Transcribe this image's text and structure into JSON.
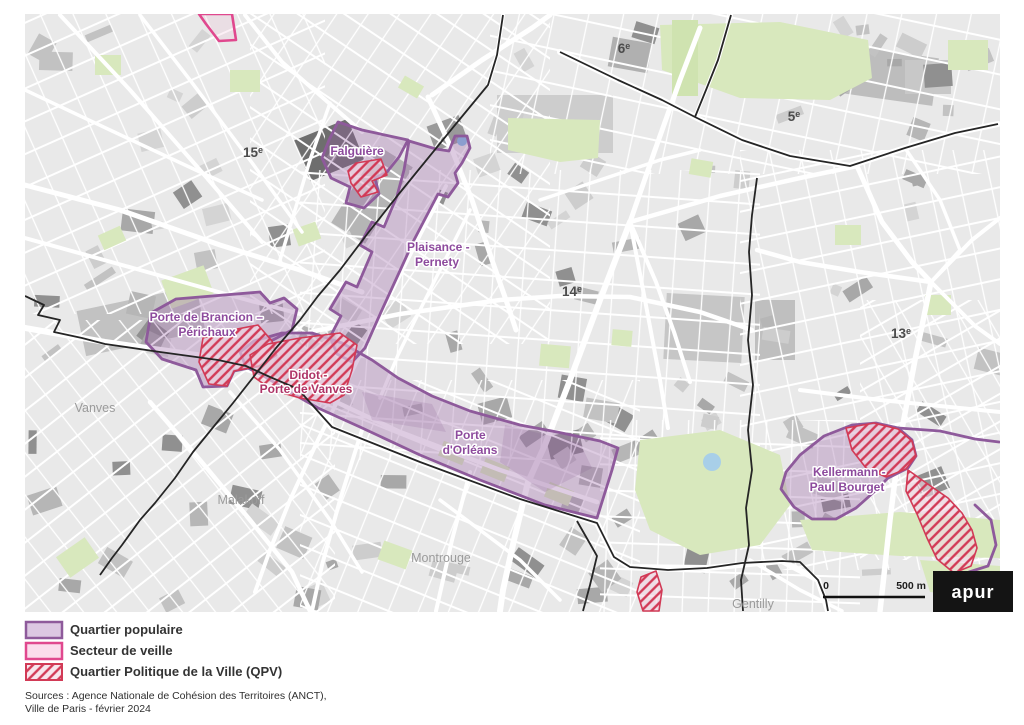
{
  "map": {
    "arrondissements": [
      {
        "num": "15",
        "sup": "e"
      },
      {
        "num": "14",
        "sup": "e"
      },
      {
        "num": "13",
        "sup": "e"
      },
      {
        "num": "6",
        "sup": "e"
      },
      {
        "num": "5",
        "sup": "e"
      }
    ],
    "communes": [
      {
        "name": "Vanves"
      },
      {
        "name": "Malakoff"
      },
      {
        "name": "Montrouge"
      },
      {
        "name": "Gentilly"
      }
    ],
    "quarters": [
      {
        "id": "falguiere",
        "lines": [
          "Falguière"
        ]
      },
      {
        "id": "plaisance-pernety",
        "lines": [
          "Plaisance -",
          "Pernety"
        ]
      },
      {
        "id": "porte-de-brancion-perichaux",
        "lines": [
          "Porte de Brancion –",
          "Périchaux"
        ]
      },
      {
        "id": "didot-porte-de-vanves",
        "lines": [
          "Didot -",
          "Porte de Vanves"
        ]
      },
      {
        "id": "porte-d-orleans",
        "lines": [
          "Porte",
          "d'Orléans"
        ]
      },
      {
        "id": "kellermann-paul-bourget",
        "lines": [
          "Kellermann -",
          "Paul Bourget"
        ]
      }
    ],
    "scalebar": {
      "zero": "0",
      "max": "500 m"
    },
    "logo_text": "apur"
  },
  "legend": {
    "items": [
      {
        "label": "Quartier populaire"
      },
      {
        "label": "Secteur de veille"
      },
      {
        "label": "Quartier Politique de la Ville (QPV)"
      }
    ]
  },
  "sources": {
    "line1": "Sources : Agence Nationale de Cohésion des Territoires (ANCT),",
    "line2": "Ville de Paris - février 2024"
  },
  "colors": {
    "quartier_populaire_stroke": "#8e5a9b",
    "quartier_populaire_fill": "rgba(151,96,166,0.32)",
    "secteur_veille_stroke": "#e0488e",
    "secteur_veille_fill": "rgba(237,170,203,0.18)",
    "qpv_red": "#d23a56",
    "label_purple": "#8d4a9d",
    "label_red": "#ae3366",
    "legend_quartier_fill": "#dcc7e2",
    "legend_veille_fill": "#fbdcec",
    "map_background": "#e9e9e9",
    "park_green": "#d8e8bd",
    "water_blue": "#85bbe4"
  }
}
